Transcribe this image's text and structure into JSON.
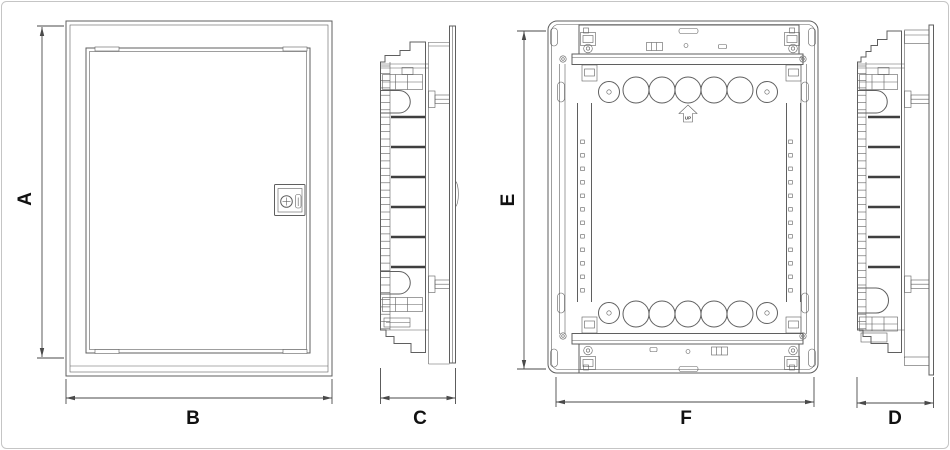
{
  "dimensions": {
    "A": "A",
    "B": "B",
    "C": "C",
    "D": "D",
    "E": "E",
    "F": "F"
  },
  "markers": {
    "up": "UP"
  },
  "colors": {
    "line": "#5f5f5f",
    "line_dark": "#3f3f3f",
    "dim": "#4a4a4a",
    "label": "#111111",
    "border": "#c5c5c5",
    "background": "#ffffff"
  }
}
